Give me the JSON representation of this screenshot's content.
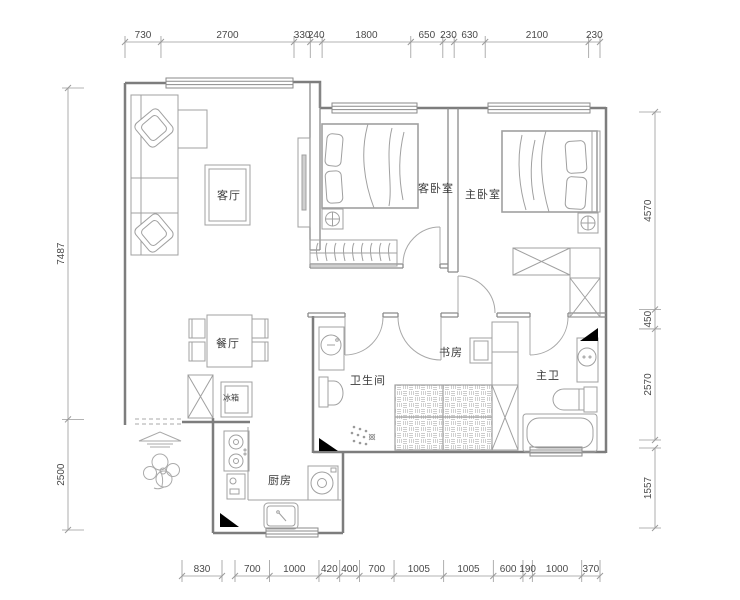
{
  "drawing": {
    "type": "residential floor plan",
    "units": "mm"
  },
  "rooms": {
    "living_room": "客厅",
    "guest_bedroom": "客卧室",
    "master_bedroom": "主卧室",
    "dining_room": "餐厅",
    "fridge": "冰箱",
    "bathroom": "卫生间",
    "study": "书房",
    "master_bathroom": "主卫",
    "kitchen": "厨房"
  },
  "dimensions": {
    "top": [
      730,
      2700,
      330,
      240,
      1800,
      650,
      230,
      630,
      2100,
      230
    ],
    "bottom_a": [
      830
    ],
    "bottom_b": [
      700,
      1000,
      420,
      400,
      700,
      1005,
      1005,
      600,
      190,
      1000,
      370
    ],
    "left": [
      7487,
      2500
    ],
    "right_a": [
      4570,
      450,
      2570
    ],
    "right_b": [
      1557
    ]
  },
  "colors": {
    "background": "#ffffff",
    "wall": "#7d7d7d",
    "interior_wall": "#8a8a8a",
    "furniture": "#a0a0a0",
    "hatch": "#b8b8b8",
    "dim_line": "#9a9a9a",
    "dim_text": "#4a4a4a",
    "label_text": "#3a3a3a",
    "shaft_marker": "#000000"
  }
}
